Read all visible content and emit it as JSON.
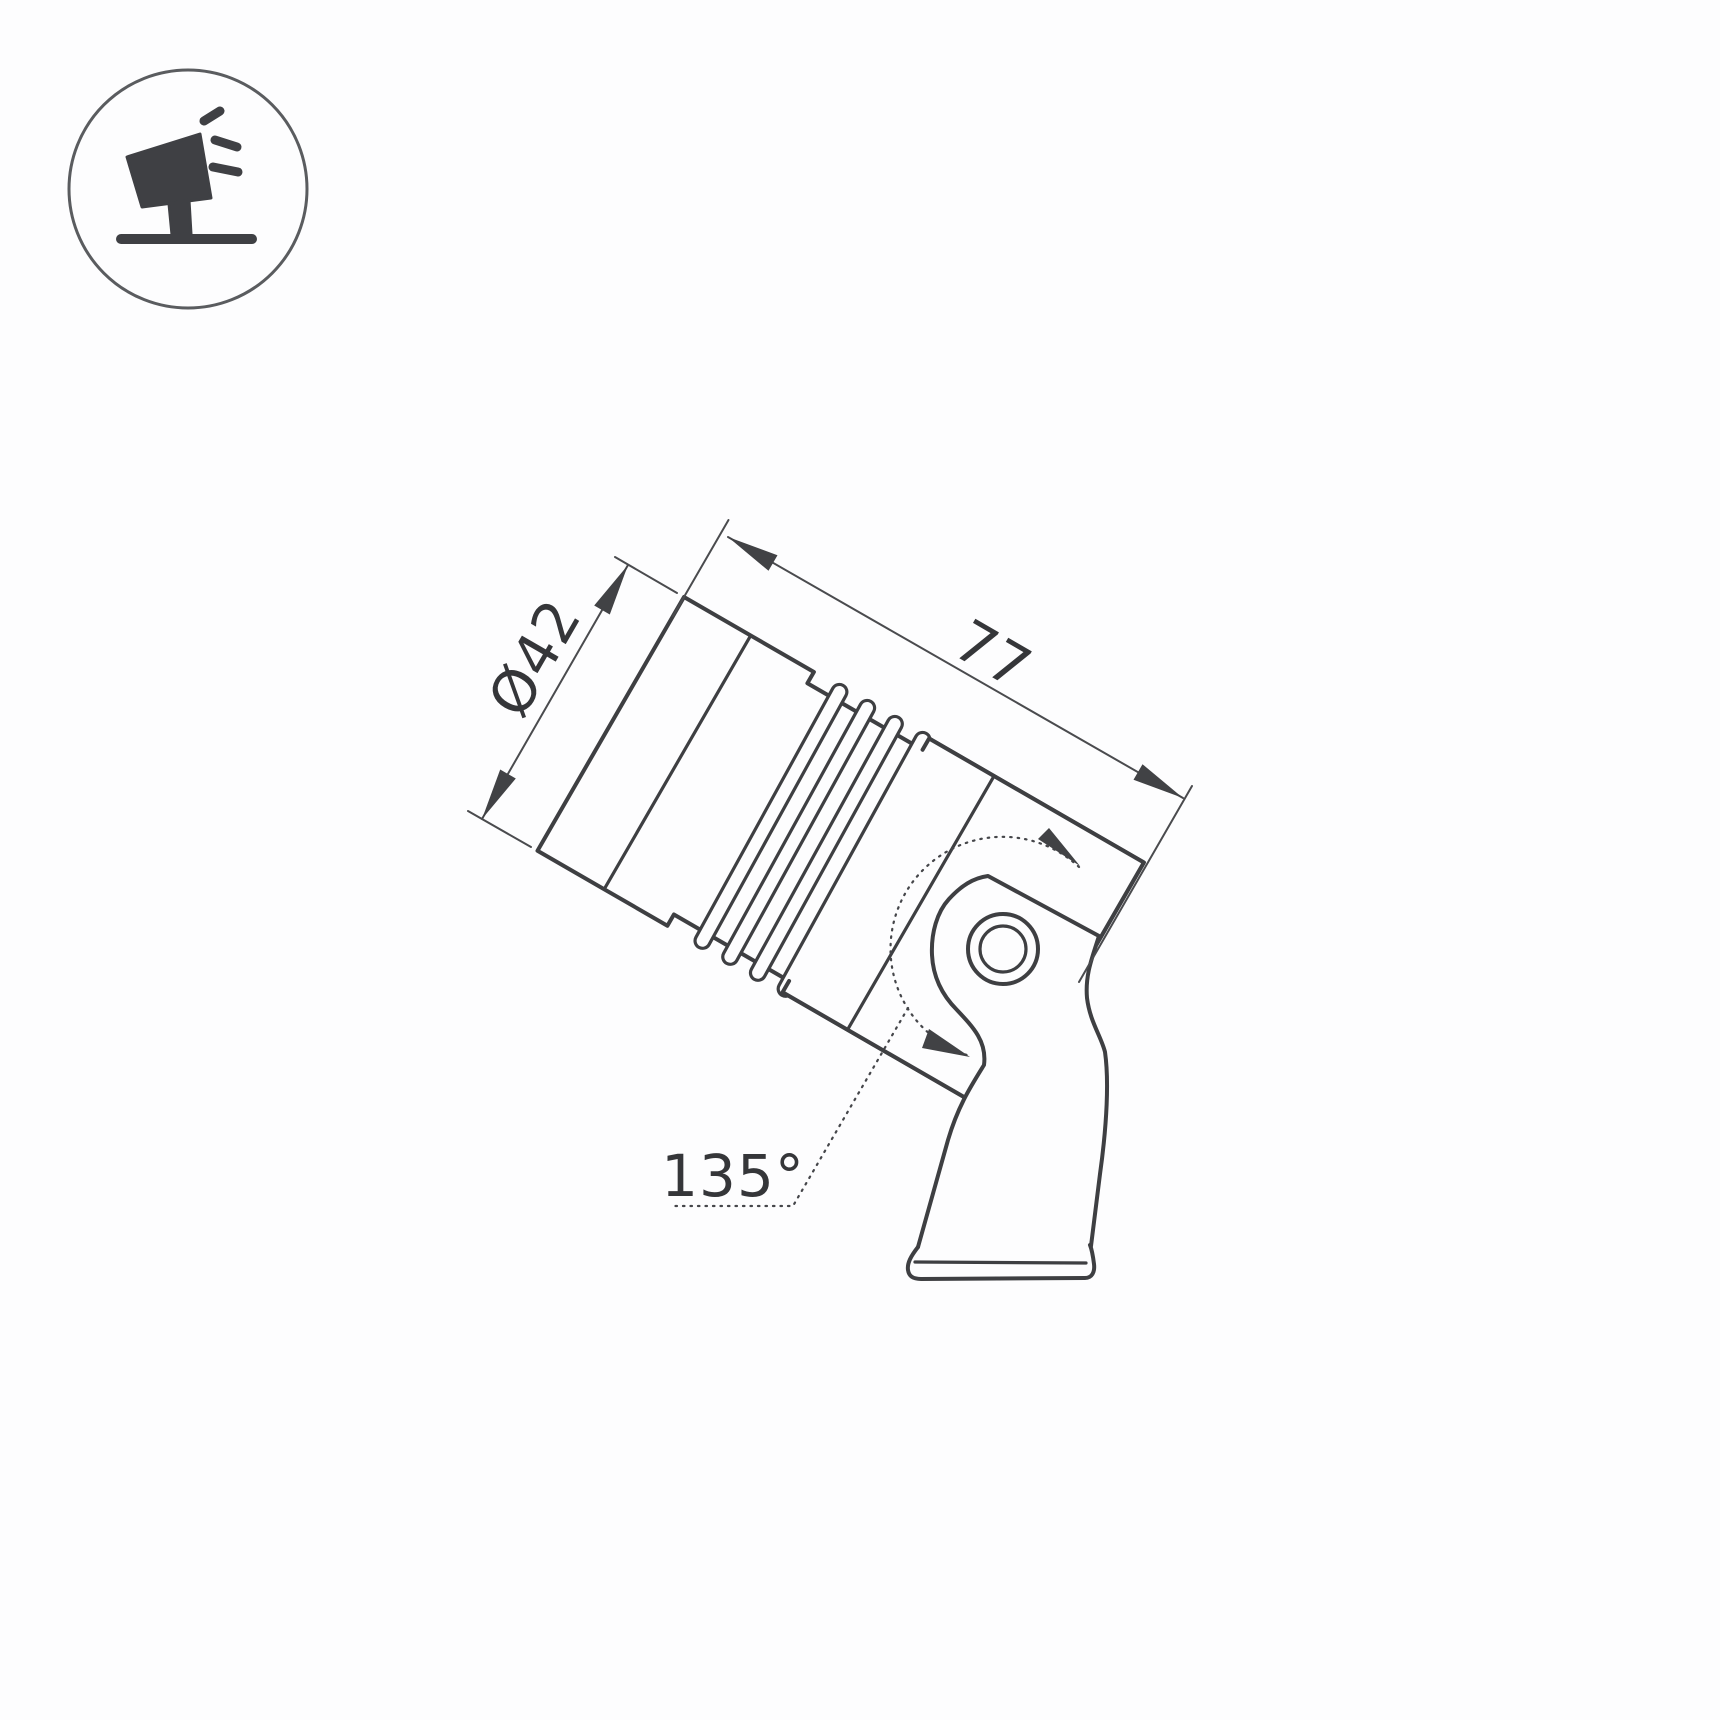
{
  "page": {
    "background": "#fdfdfe"
  },
  "colors": {
    "outline": "#3e3f42",
    "thin_line": "#4a4b4e",
    "label": "#353639",
    "icon": "#3f4044",
    "icon_ring": "#5a5c5f"
  },
  "icon": {
    "name": "tilted-spotlight-badge"
  },
  "dimensions": {
    "diameter": "Ø42",
    "length": "77",
    "angle": "135°"
  }
}
